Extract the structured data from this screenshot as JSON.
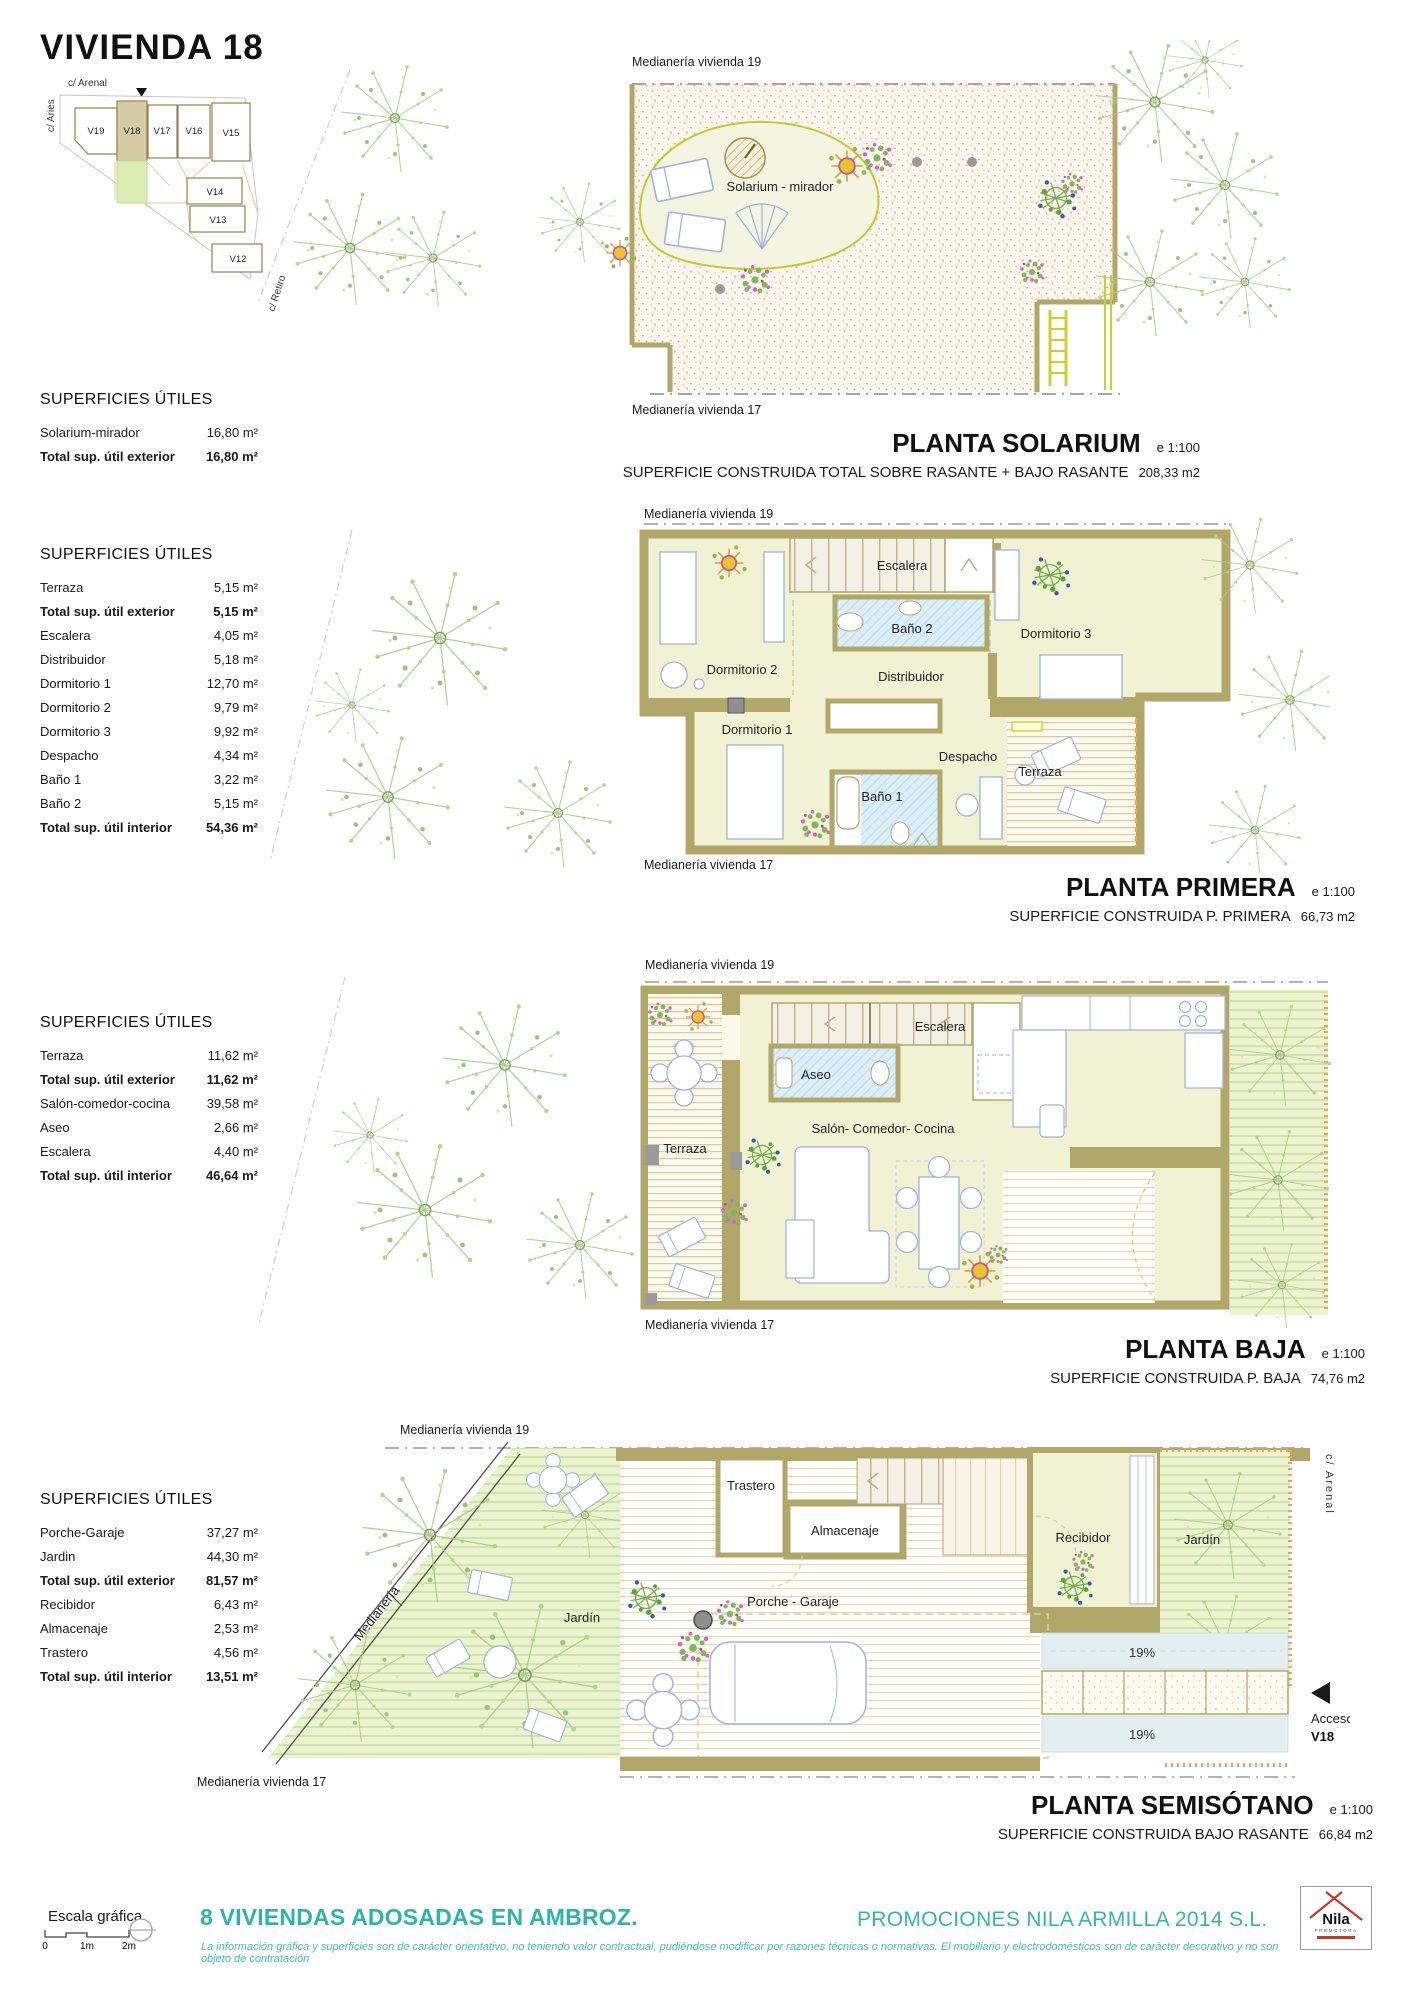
{
  "header": {
    "title": "VIVIENDA 18",
    "keyplan": {
      "street_top": "c/ Arenal",
      "street_left": "c/ Aries",
      "street_right": "c/ Retiro",
      "plots": [
        "V19",
        "V18",
        "V17",
        "V16",
        "V15",
        "V14",
        "V13",
        "V12"
      ],
      "highlighted": "V18"
    }
  },
  "surfaces": [
    {
      "title": "SUPERFICIES ÚTILES",
      "rows": [
        {
          "label": "Solarium-mirador",
          "value": "16,80 m²"
        },
        {
          "label": "Total sup. útil exterior",
          "value": "16,80 m²"
        }
      ]
    },
    {
      "title": "SUPERFICIES ÚTILES",
      "rows": [
        {
          "label": "Terraza",
          "value": "5,15 m²"
        },
        {
          "label": "Total sup. útil exterior",
          "value": "5,15 m²"
        },
        {
          "label": "Escalera",
          "value": "4,05 m²"
        },
        {
          "label": "Distribuidor",
          "value": "5,18 m²"
        },
        {
          "label": "Dormitorio 1",
          "value": "12,70 m²"
        },
        {
          "label": "Dormitorio 2",
          "value": "9,79 m²"
        },
        {
          "label": "Dormitorio 3",
          "value": "9,92 m²"
        },
        {
          "label": "Despacho",
          "value": "4,34 m²"
        },
        {
          "label": "Baño 1",
          "value": "3,22 m²"
        },
        {
          "label": "Baño 2",
          "value": "5,15 m²"
        },
        {
          "label": "Total sup. útil interior",
          "value": "54,36 m²"
        }
      ]
    },
    {
      "title": "SUPERFICIES ÚTILES",
      "rows": [
        {
          "label": "Terraza",
          "value": "11,62 m²"
        },
        {
          "label": "Total sup. útil exterior",
          "value": "11,62 m²"
        },
        {
          "label": "Salón-comedor-cocina",
          "value": "39,58 m²"
        },
        {
          "label": "Aseo",
          "value": "2,66 m²"
        },
        {
          "label": "Escalera",
          "value": "4,40 m²"
        },
        {
          "label": "Total sup. útil interior",
          "value": "46,64 m²"
        }
      ]
    },
    {
      "title": "SUPERFICIES ÚTILES",
      "rows": [
        {
          "label": "Porche-Garaje",
          "value": "37,27 m²"
        },
        {
          "label": "Jardin",
          "value": "44,30 m²"
        },
        {
          "label": "Total sup. útil exterior",
          "value": "81,57 m²"
        },
        {
          "label": "Recibidor",
          "value": "6,43 m²"
        },
        {
          "label": "Almacenaje",
          "value": "2,53 m²"
        },
        {
          "label": "Trastero",
          "value": "4,56 m²"
        },
        {
          "label": "Total sup. útil interior",
          "value": "13,51 m²"
        }
      ]
    }
  ],
  "plans": {
    "solarium": {
      "title": "PLANTA SOLARIUM",
      "scale": "e 1:100",
      "subtitle": "SUPERFICIE CONSTRUIDA TOTAL SOBRE RASANTE + BAJO RASANTE",
      "area": "208,33 m2",
      "party_top": "Medianería vivienda 19",
      "party_bottom": "Medianería vivienda 17",
      "room": "Solarium - mirador"
    },
    "primera": {
      "title": "PLANTA PRIMERA",
      "scale": "e 1:100",
      "subtitle": "SUPERFICIE CONSTRUIDA P. PRIMERA",
      "area": "66,73 m2",
      "party_top": "Medianería vivienda 19",
      "party_bottom": "Medianería vivienda 17",
      "rooms": {
        "escalera": "Escalera",
        "bano2": "Baño 2",
        "dorm3": "Dormitorio 3",
        "dorm2": "Dormitorio 2",
        "distribuidor": "Distribuidor",
        "dorm1": "Dormitorio 1",
        "despacho": "Despacho",
        "terraza": "Terraza",
        "bano1": "Baño 1"
      }
    },
    "baja": {
      "title": "PLANTA BAJA",
      "scale": "e 1:100",
      "subtitle": "SUPERFICIE CONSTRUIDA P. BAJA",
      "area": "74,76 m2",
      "party_top": "Medianería vivienda 19",
      "party_bottom": "Medianería vivienda 17",
      "rooms": {
        "escalera": "Escalera",
        "aseo": "Aseo",
        "salon": "Salón- Comedor- Cocina",
        "terraza": "Terraza"
      }
    },
    "semisotano": {
      "title": "PLANTA SEMISÓTANO",
      "scale": "e 1:100",
      "subtitle": "SUPERFICIE CONSTRUIDA BAJO RASANTE",
      "area": "66,84 m2",
      "party_top": "Medianería vivienda 19",
      "party_bottom": "Medianería vivienda 17",
      "party_diag": "Medianería",
      "street_right": "c/ Arenal",
      "rooms": {
        "trastero": "Trastero",
        "almacenaje": "Almacenaje",
        "recibidor": "Recibidor",
        "jardin_left": "Jardín",
        "jardin_right": "Jardín",
        "porche": "Porche - Garaje"
      },
      "ramp1": "19%",
      "ramp2": "19%",
      "acceso_label": "Acceso",
      "acceso_unit": "V18"
    }
  },
  "footer": {
    "scale_label": "Escala gráfica",
    "scale_ticks": [
      "0",
      "1m",
      "2m"
    ],
    "project": "8 VIVIENDAS ADOSADAS EN AMBROZ.",
    "disclaimer": "La información gráfica y superficies son de carácter orientativo, no teniendo valor contractual, pudiéndose modificar por razones técnicas o normativas. El mobiliario y electrodomésticos son de carácter decorativo y no son objeto de contratación",
    "developer": "PROMOCIONES NILA ARMILLA 2014 S.L.",
    "logo_name": "Nila",
    "logo_sub": "PROMOTORA"
  },
  "colors": {
    "teal": "#2eb3ab",
    "wall": "#b1a768",
    "floor": "#f1f2d3",
    "bath": "#dceef8",
    "garden": "#ebf3d0",
    "speckle": "#f2b183",
    "ramp": "#e3eef0"
  }
}
